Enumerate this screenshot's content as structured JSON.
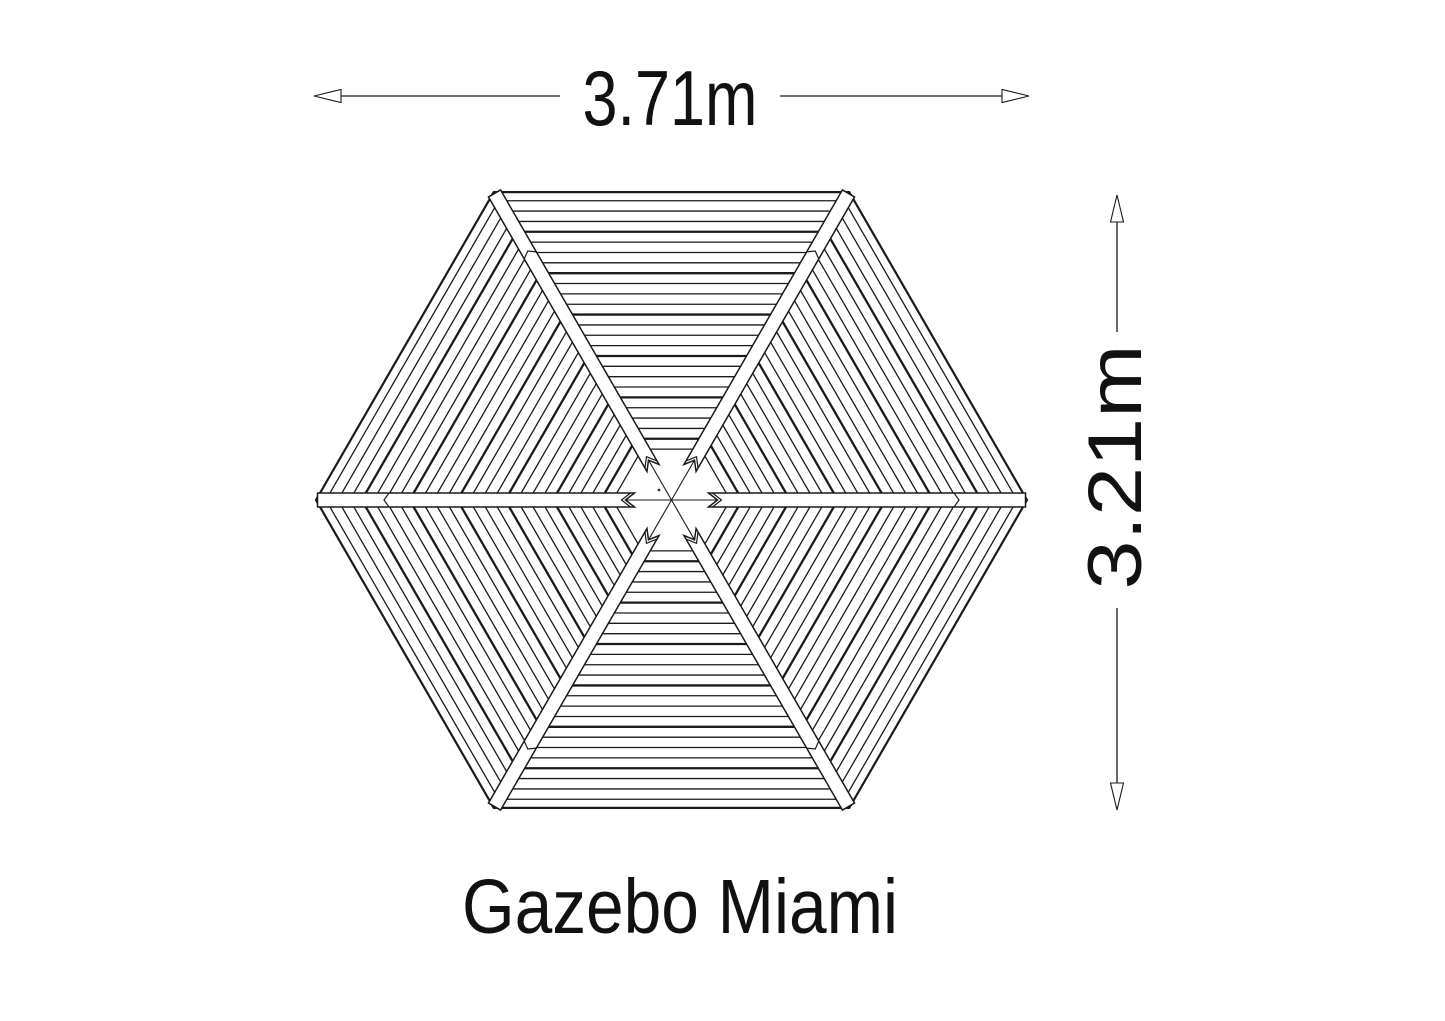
{
  "title": {
    "text": "Gazebo Miami"
  },
  "dimensions": {
    "width": {
      "label": "3.71m",
      "meters": 3.71,
      "orientation": "horizontal"
    },
    "height": {
      "label": "3.21m",
      "meters": 3.21,
      "orientation": "vertical"
    }
  },
  "diagram": {
    "type": "roof-plan-view",
    "shape": "hexagon",
    "product": "Gazebo Miami",
    "sections": 6,
    "description": "Top view of a hexagonal gazebo roof: six triangular sections of parallel roof boards separated by hip rafters radiating from the centre.",
    "colors": {
      "line": "#1a1a1a",
      "background": "#ffffff",
      "rafter_fill": "#ffffff"
    },
    "geometry": {
      "center_x": 671.5,
      "center_y": 500,
      "circumradius": 355.5,
      "vertex_angles_deg": [
        0,
        60,
        120,
        180,
        240,
        300
      ],
      "board_first_offset": 8.6,
      "board_spacing": 10.35,
      "board_count": 25,
      "thick_every": 4,
      "center_hole_radius": 48,
      "bar_half_width": 7,
      "bar_inner_radius": 37,
      "bar_notch_depth": 9,
      "bar_inner_chevron_start": 41,
      "bar_inner_chevron_depth": 9,
      "bar_seam_from_vertex": 73,
      "stray_dot_x": 659,
      "stray_dot_y": 490,
      "stroke_outline": 2.2,
      "stroke_board": 1.3,
      "stroke_board_thick": 2.3,
      "stroke_radial": 1.1,
      "stroke_bar": 1.5,
      "stroke_dim": 1.3
    },
    "top_dimension": {
      "y": 96,
      "tip1_x": 314,
      "tip2_x": 1029,
      "line1_end_x": 560,
      "line2_start_x": 780
    },
    "right_dimension": {
      "x": 1117,
      "tip1_y": 195,
      "tip2_y": 810,
      "line1_end_y": 332,
      "line2_start_y": 608
    },
    "arrowhead": {
      "length": 27,
      "half_width": 6.5
    }
  }
}
